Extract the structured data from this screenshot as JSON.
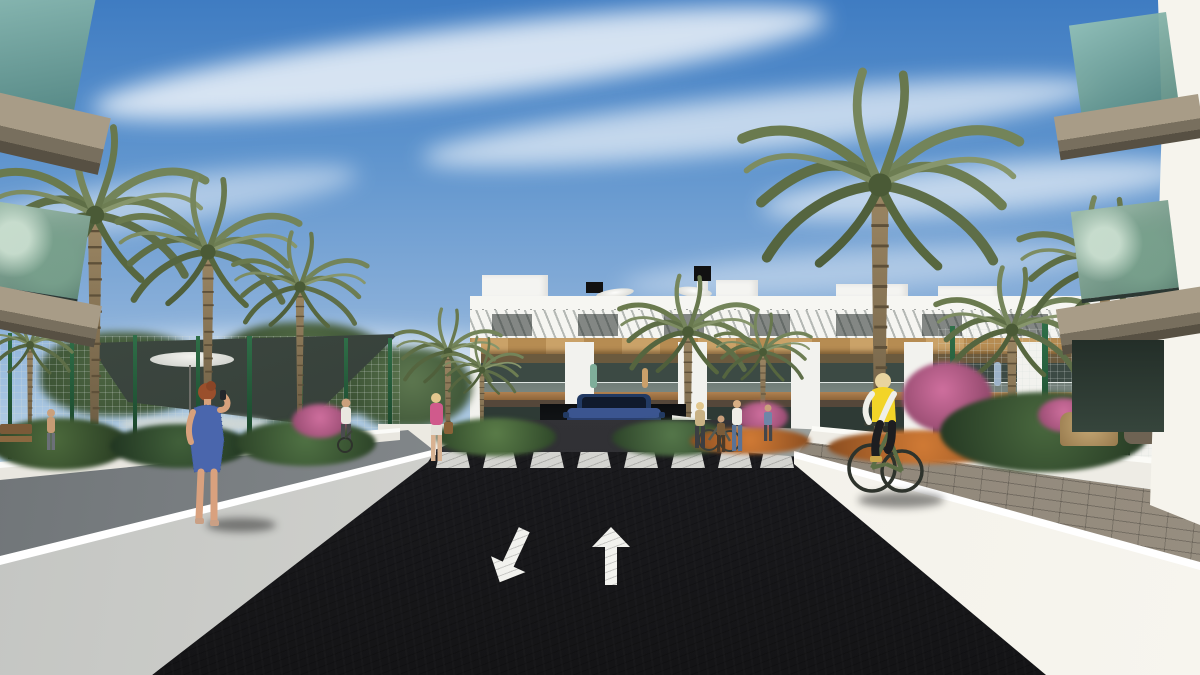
{
  "scene": {
    "type": "3d-architectural-visualization",
    "subject": "Modern white apartment complex with palm-lined entrance road, crosswalk and underground parking ramp",
    "time_of_day": "daytime, sunny with wispy clouds",
    "camera": "street-level one-point perspective looking down the access road"
  },
  "palette": {
    "sky_top": "#3f7cc2",
    "sky_horizon": "#d7e4ec",
    "asphalt": "#1c1c20",
    "road_marking_white": "#f2f2ee",
    "wall_sunlit": "#f3f1ea",
    "wall_shaded": "#c4c7c6",
    "walkway_shaded_gray": "#83888b",
    "paver_path": "#8b8276",
    "facade_white": "#f4f4f0",
    "facade_wood": "#c39a5e",
    "window_glass_dark": "#3c4a44",
    "balcony_glass_teal": "#79a89d",
    "palm_frond_green": "#6a7a4e",
    "palm_trunk_brown": "#8a775a",
    "fence_green": "#1f5a38",
    "shade_sail_dark": "#3a433d",
    "flowers_pink": "#cf6f9e",
    "flowers_orange": "#cc7a33",
    "car_blue": "#2a3f6e",
    "cyclist_vest_yellow": "#f2d428",
    "dress_blue": "#4a66ad",
    "jacket_pink": "#d05a8c"
  },
  "road": {
    "left_lane_arrow": "points toward viewer (down-left)",
    "right_lane_arrow": "points away from viewer (up)",
    "crosswalk_stripe_count": 8,
    "small_ramp_arrows": 2
  },
  "objects": {
    "building_floors_visible": 3,
    "rooftop_parasols": 2,
    "rooftop_chimneys": 2,
    "palm_tree_count": 11,
    "vehicles": [
      {
        "kind": "suv",
        "color": "#2a3f6e",
        "location": "exiting underground parking ramp at center"
      }
    ],
    "people": [
      {
        "kind": "woman on phone",
        "outfit": "blue patterned dress",
        "hair": "auburn",
        "location": "left walkway"
      },
      {
        "kind": "cyclist",
        "outfit": "yellow vest, white sleeves, black pants",
        "location": "right paver path"
      },
      {
        "kind": "woman walking with handbag",
        "outfit": "pink jacket",
        "location": "center-left path"
      },
      {
        "kind": "person with bicycle",
        "outfit": "white shirt",
        "location": "far center-left path"
      },
      {
        "kind": "group of four with bicycle",
        "location": "right of crosswalk"
      },
      {
        "kind": "shirtless man",
        "location": "pool garden behind green fence, far left"
      }
    ],
    "landscape": [
      "date palms",
      "green mesh fence",
      "dark shade sail",
      "white parasol",
      "bougainvillea pink flowers",
      "orange flower planters",
      "white planter walls",
      "wicker chairs"
    ]
  }
}
